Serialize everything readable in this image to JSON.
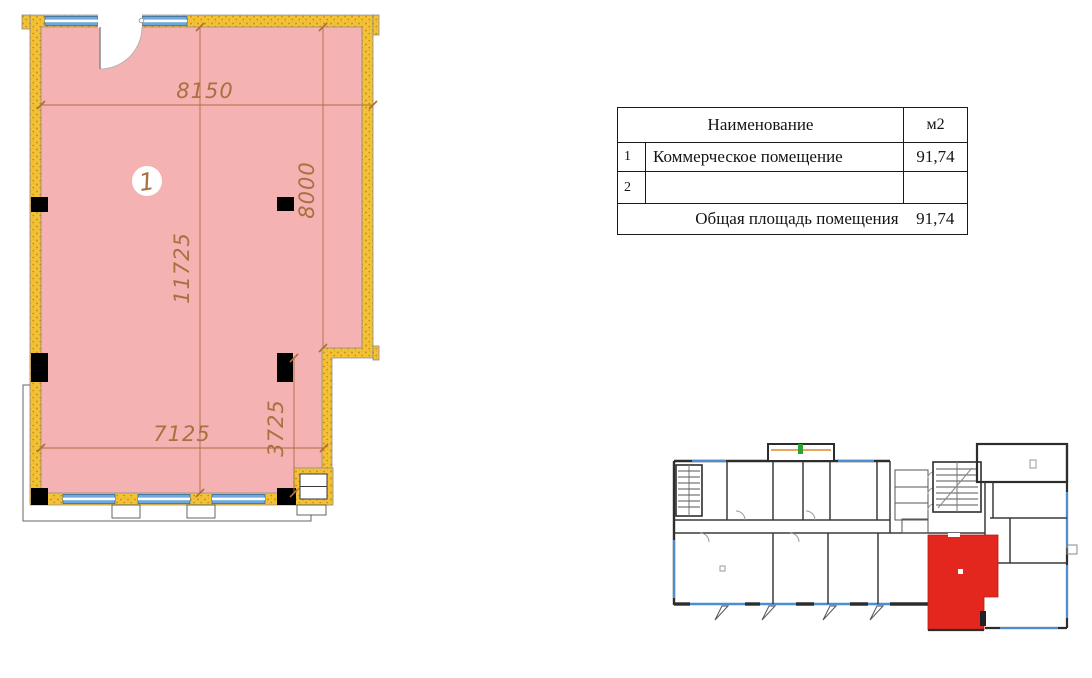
{
  "page": {
    "background": "#ffffff"
  },
  "floor_plan": {
    "room_number": "1",
    "dimensions": {
      "width_top_mm": "8150",
      "height_right_mm": "8000",
      "height_full_mm": "11725",
      "width_bottom_mm": "7125",
      "height_lower_right_mm": "3725"
    },
    "colors": {
      "room_fill": "#f4b2b2",
      "wall_yellow": "#f2c235",
      "wall_speckle": "#d98a1f",
      "window_blue": "#6fa8dc",
      "dimension_brown": "#a9713f",
      "column_black": "#000000"
    }
  },
  "area_table": {
    "header": {
      "name_label": "Наименование",
      "area_label": "м2"
    },
    "rows": [
      {
        "num": "1",
        "name": "Коммерческое помещение",
        "area": "91,74"
      },
      {
        "num": "2",
        "name": "",
        "area": ""
      }
    ],
    "footer": {
      "label": "Общая площадь помещения",
      "area": "91,74"
    }
  },
  "overview_plan": {
    "highlight_color": "#e3271f",
    "wall_color": "#2d2d2d",
    "window_color": "#4a8fd4"
  }
}
